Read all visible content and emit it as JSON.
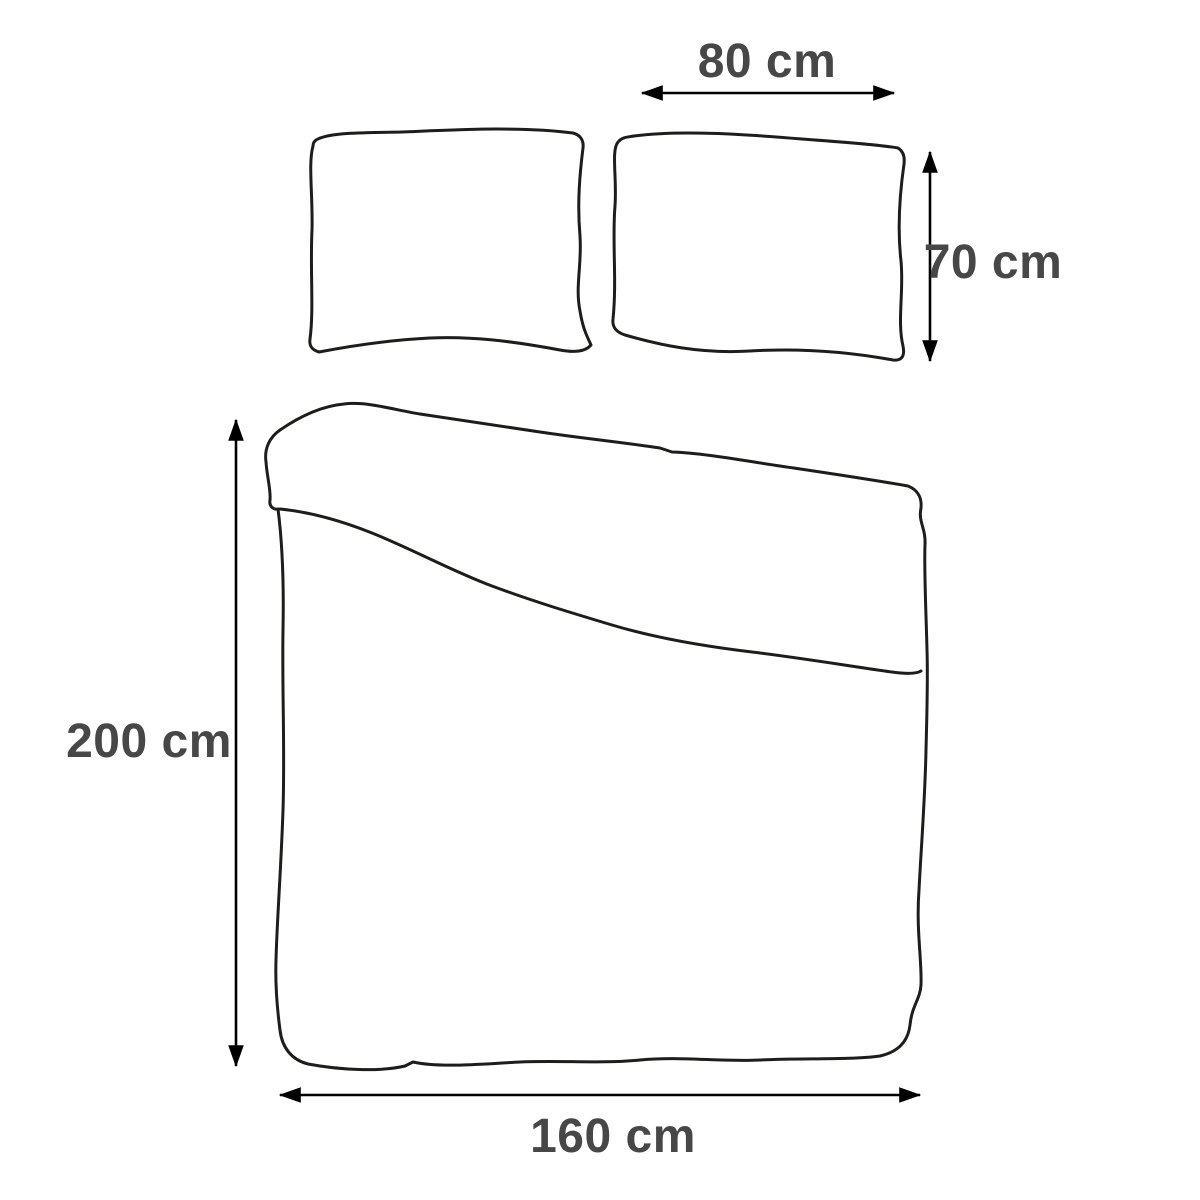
{
  "diagram": {
    "title": "Bedding set dimensions",
    "colors": {
      "background": "#ffffff",
      "outline": "#1d1d1b",
      "arrow": "#000000",
      "label": "#474747"
    },
    "items": [
      {
        "name": "pillowcase",
        "count": 2,
        "width_cm": 80,
        "height_cm": 70
      },
      {
        "name": "duvet-cover",
        "count": 1,
        "width_cm": 160,
        "height_cm": 200
      }
    ],
    "labels": {
      "pillow_width": "80 cm",
      "pillow_height": "70 cm",
      "duvet_height": "200 cm",
      "duvet_width": "160 cm"
    }
  }
}
